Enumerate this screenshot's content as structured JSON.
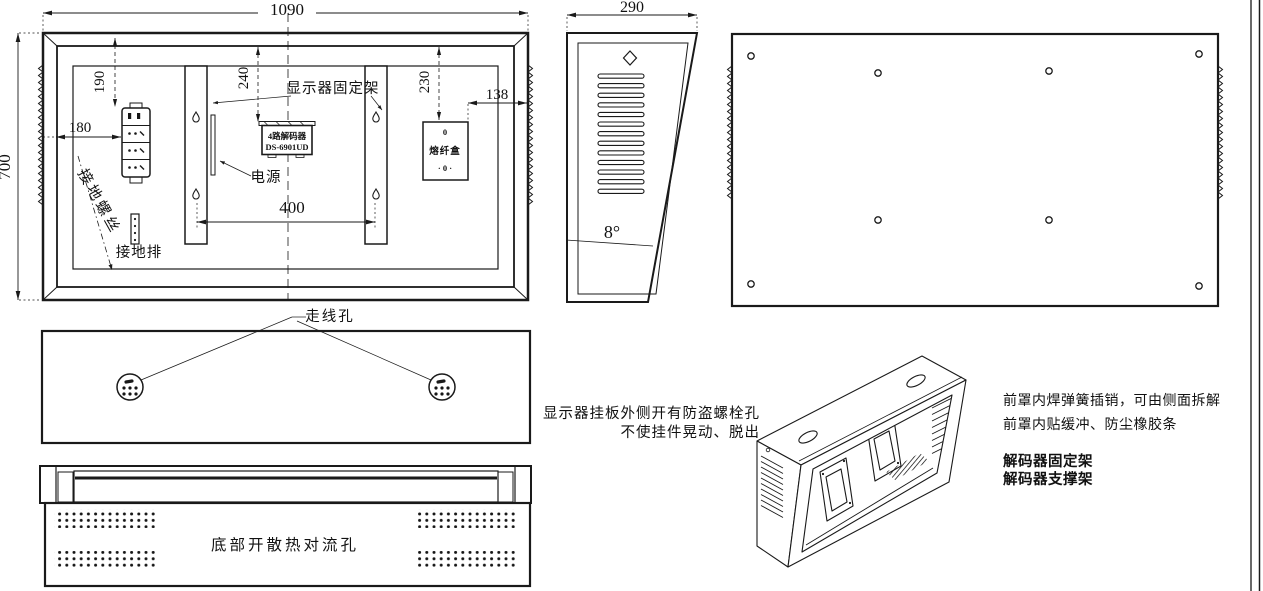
{
  "colors": {
    "ink": "#1a1a1a",
    "background": "#ffffff"
  },
  "front": {
    "dim_width": "1090",
    "dim_height": "700",
    "dim_190": "190",
    "dim_240": "240",
    "dim_230": "230",
    "dim_138": "138",
    "dim_180": "180",
    "dim_400": "400",
    "label_bracket": "显示器固定架",
    "label_power": "电源",
    "label_ground_screw": "接地螺丝",
    "label_ground_bar": "接地排",
    "decoder_line1": "4路解码器",
    "decoder_line2": "DS-6901UD",
    "fiber_top": "0",
    "fiber_name": "熔纤盒",
    "fiber_bottom": "· 0 ·"
  },
  "side": {
    "dim_width": "290",
    "angle": "8°"
  },
  "plate": {
    "label_cable_hole": "走线孔"
  },
  "bottom": {
    "label": "底部开散热对流孔"
  },
  "notes": {
    "left_line1": "显示器挂板外侧开有防盗螺栓孔",
    "left_line2": "不使挂件晃动、脱出",
    "right_line1": "前罩内焊弹簧插销，可由侧面拆解",
    "right_line2": "前罩内贴缓冲、防尘橡胶条",
    "right_bold1": "解码器固定架",
    "right_bold2": "解码器支撑架"
  }
}
